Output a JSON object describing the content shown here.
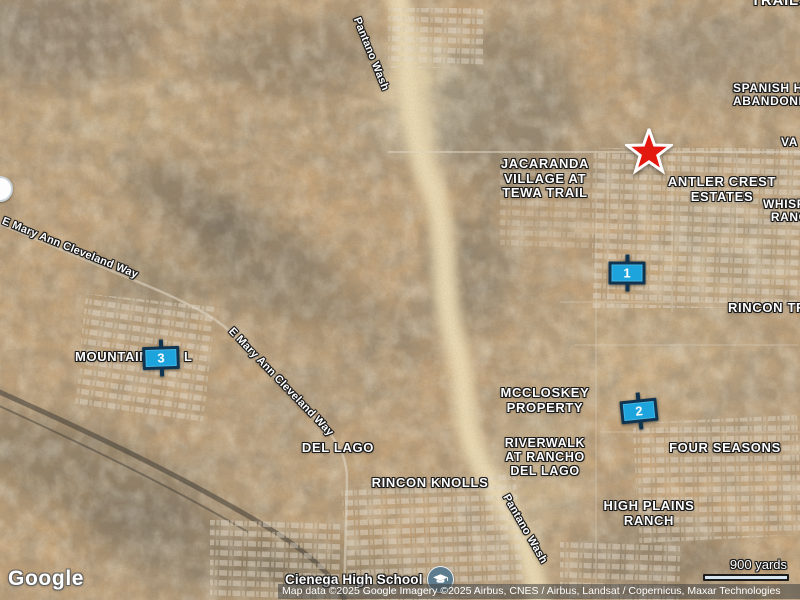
{
  "branding": {
    "logo": "Google"
  },
  "attribution": {
    "text": "Map data ©2025 Google Imagery ©2025 Airbus, CNES / Airbus, Landsat / Copernicus, Maxar Technologies"
  },
  "scale_bar": {
    "label": "900 yards"
  },
  "school_poi": {
    "label": "Cienega High School",
    "icon": "graduation-cap-icon"
  },
  "colors": {
    "sign_fill": "#1ea4dc",
    "sign_border": "#10344f",
    "star_red": "#e3180f",
    "school_icon_bg": "#5d7d8f",
    "scalebar_fill": "#d9e7f0",
    "label_text": "#ffffff"
  },
  "place_labels": [
    {
      "id": "trails",
      "lines": [
        "TRAILS"
      ],
      "x": 751,
      "y": -7,
      "size": 15,
      "align": "left"
    },
    {
      "id": "spanish-abandonment",
      "lines": [
        "SPANISH H",
        "ABANDONM"
      ],
      "x": 733,
      "y": 82,
      "size": 12,
      "align": "left"
    },
    {
      "id": "va",
      "lines": [
        "VA"
      ],
      "x": 781,
      "y": 136,
      "size": 12,
      "align": "left"
    },
    {
      "id": "jacaranda-village",
      "lines": [
        "JACARANDA",
        "VILLAGE AT",
        "TEWA TRAIL"
      ],
      "x": 545,
      "y": 157,
      "size": 13,
      "align": "center"
    },
    {
      "id": "antler-crest",
      "lines": [
        "ANTLER CREST",
        "ESTATES"
      ],
      "x": 722,
      "y": 175,
      "size": 13,
      "align": "center"
    },
    {
      "id": "whisper-ranch",
      "lines": [
        "WHISPE",
        "  RANCH"
      ],
      "x": 763,
      "y": 198,
      "size": 12,
      "align": "left"
    },
    {
      "id": "rincon-trails",
      "lines": [
        "RINCON TRA"
      ],
      "x": 728,
      "y": 301,
      "size": 13,
      "align": "left"
    },
    {
      "id": "mountain",
      "lines": [
        "MOUNTAIN"
      ],
      "x": 75,
      "y": 350,
      "size": 13,
      "align": "left"
    },
    {
      "id": "mountain-l",
      "lines": [
        "L"
      ],
      "x": 184,
      "y": 350,
      "size": 13,
      "align": "left"
    },
    {
      "id": "mccloskey-property",
      "lines": [
        "MCCLOSKEY",
        "PROPERTY"
      ],
      "x": 545,
      "y": 386,
      "size": 13,
      "align": "center"
    },
    {
      "id": "del-lago",
      "lines": [
        "DEL LAGO"
      ],
      "x": 338,
      "y": 441,
      "size": 13,
      "align": "center"
    },
    {
      "id": "riverwalk-at-rancho-del-lago",
      "lines": [
        "RIVERWALK",
        "AT RANCHO",
        "DEL LAGO"
      ],
      "x": 545,
      "y": 436,
      "size": 12.5,
      "align": "center"
    },
    {
      "id": "rincon-knolls",
      "lines": [
        "RINCON KNOLLS"
      ],
      "x": 430,
      "y": 476,
      "size": 13,
      "align": "center"
    },
    {
      "id": "four-seasons",
      "lines": [
        "FOUR SEASONS"
      ],
      "x": 725,
      "y": 441,
      "size": 13,
      "align": "center"
    },
    {
      "id": "high-plains-ranch",
      "lines": [
        "HIGH PLAINS",
        "RANCH"
      ],
      "x": 649,
      "y": 499,
      "size": 13,
      "align": "center"
    }
  ],
  "road_labels": [
    {
      "id": "e-mary-ann-cleveland-way-west",
      "text": "E Mary Ann Cleveland Way",
      "x": 70,
      "y": 248,
      "rotate": 22,
      "size": 11
    },
    {
      "id": "e-mary-ann-cleveland-way-east",
      "text": "E Mary Ann Cleveland Way",
      "x": 281,
      "y": 382,
      "rotate": 46,
      "size": 11
    },
    {
      "id": "pantano-wash-north",
      "text": "Pantano Wash",
      "x": 371,
      "y": 54,
      "rotate": 68,
      "size": 11
    },
    {
      "id": "pantano-wash-south",
      "text": "Pantano Wash",
      "x": 525,
      "y": 529,
      "rotate": 60,
      "size": 11
    }
  ],
  "markers": {
    "star": {
      "x": 649,
      "y": 155
    },
    "signs": [
      {
        "number": "1",
        "x": 627,
        "y": 273,
        "rotate": 0
      },
      {
        "number": "2",
        "x": 639,
        "y": 411,
        "rotate": -6
      },
      {
        "number": "3",
        "x": 161,
        "y": 358,
        "rotate": -2
      }
    ]
  }
}
